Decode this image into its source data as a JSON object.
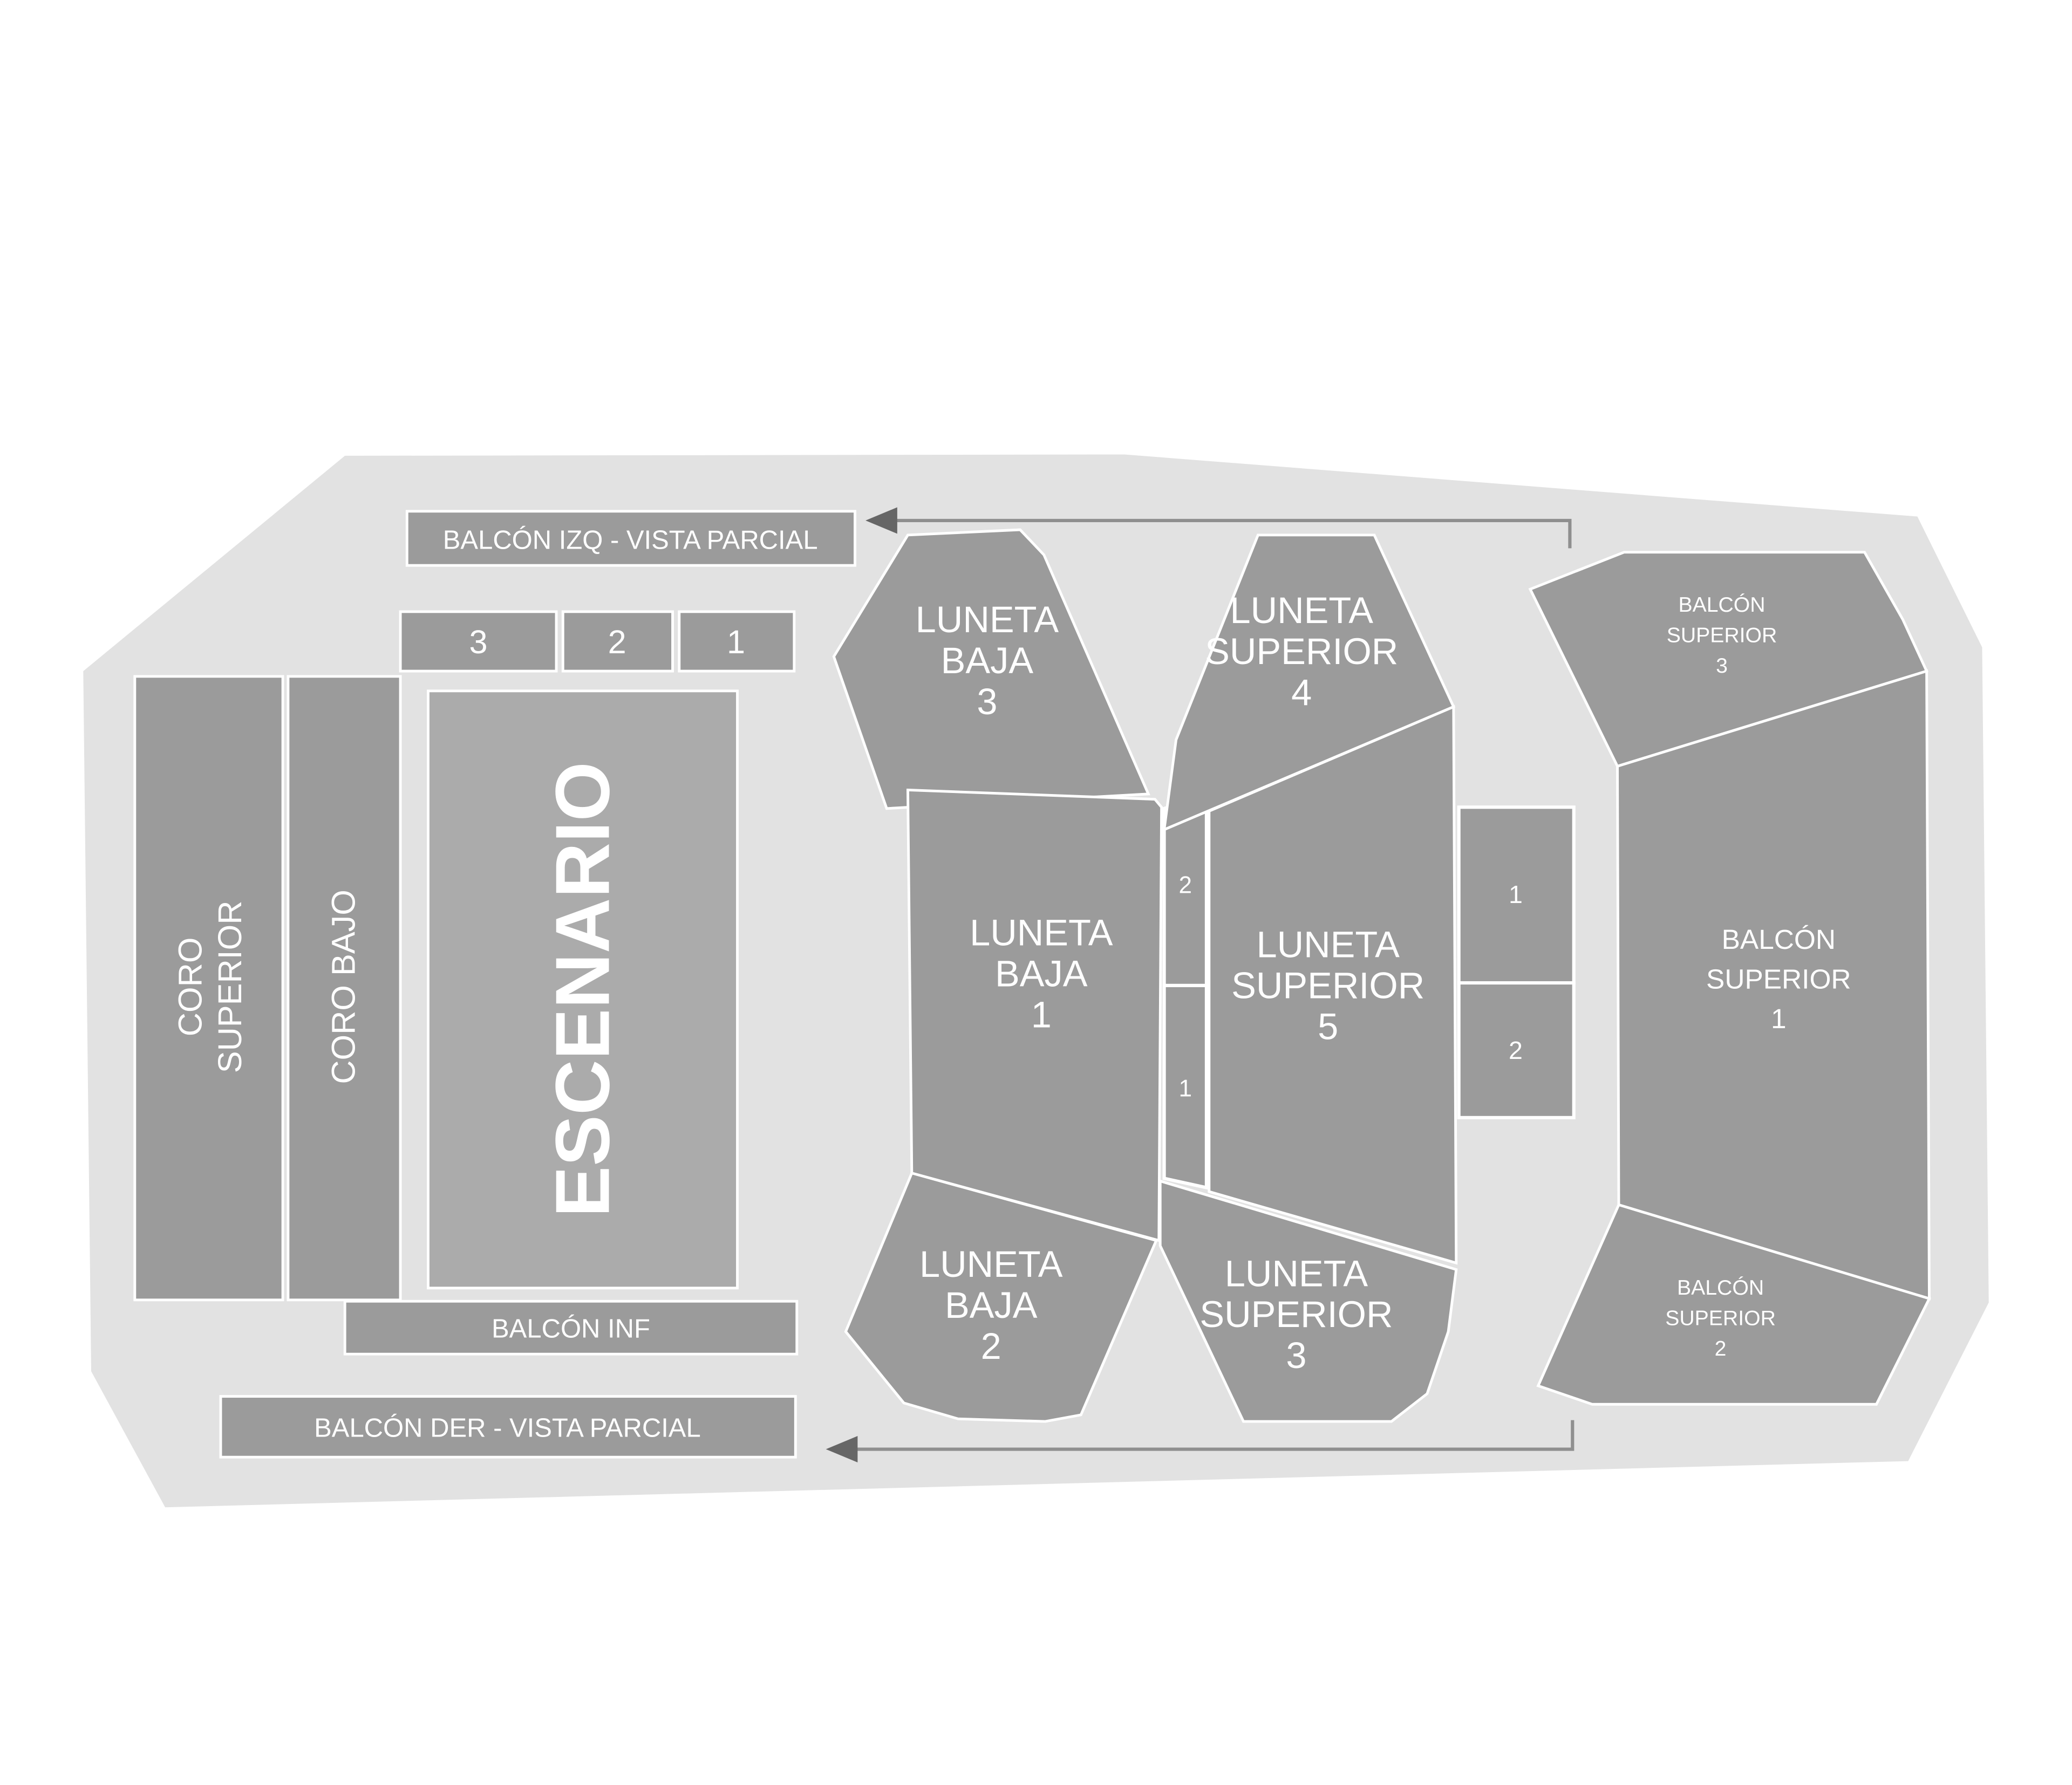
{
  "colors": {
    "floor": "#e2e2e2",
    "section": "#9b9b9b",
    "stage": "#ababab",
    "label": "#ffffff",
    "arrow_line": "#8f8f8f",
    "arrow_head": "#666666"
  },
  "bars": {
    "balcon_izq": "BALCÓN IZQ - VISTA PARCIAL",
    "balcon_inf": "BALCÓN INF",
    "balcon_der": "BALCÓN DER - VISTA PARCIAL"
  },
  "stage": {
    "label": "ESCENARIO"
  },
  "coro": {
    "superior_lines": [
      "CORO",
      "SUPERIOR"
    ],
    "bajo": "CORO BAJO"
  },
  "stage_row": {
    "box3": "3",
    "box2": "2",
    "box1": "1"
  },
  "lunetas": {
    "baja_3": [
      "LUNETA",
      "BAJA",
      "3"
    ],
    "baja_1": [
      "LUNETA",
      "BAJA",
      "1"
    ],
    "baja_2": [
      "LUNETA",
      "BAJA",
      "2"
    ],
    "superior_4": [
      "LUNETA",
      "SUPERIOR",
      "4"
    ],
    "superior_5": [
      "LUNETA",
      "SUPERIOR",
      "5"
    ],
    "superior_3": [
      "LUNETA",
      "SUPERIOR",
      "3"
    ]
  },
  "balcones": {
    "superior_3": [
      "BALCÓN",
      "SUPERIOR",
      "3"
    ],
    "superior_1": [
      "BALCÓN",
      "SUPERIOR",
      "1"
    ],
    "superior_2": [
      "BALCÓN",
      "SUPERIOR",
      "2"
    ]
  },
  "mini_sections": {
    "strip_top": "2",
    "strip_bottom": "1",
    "right_box_top": "1",
    "right_box_bottom": "2"
  }
}
